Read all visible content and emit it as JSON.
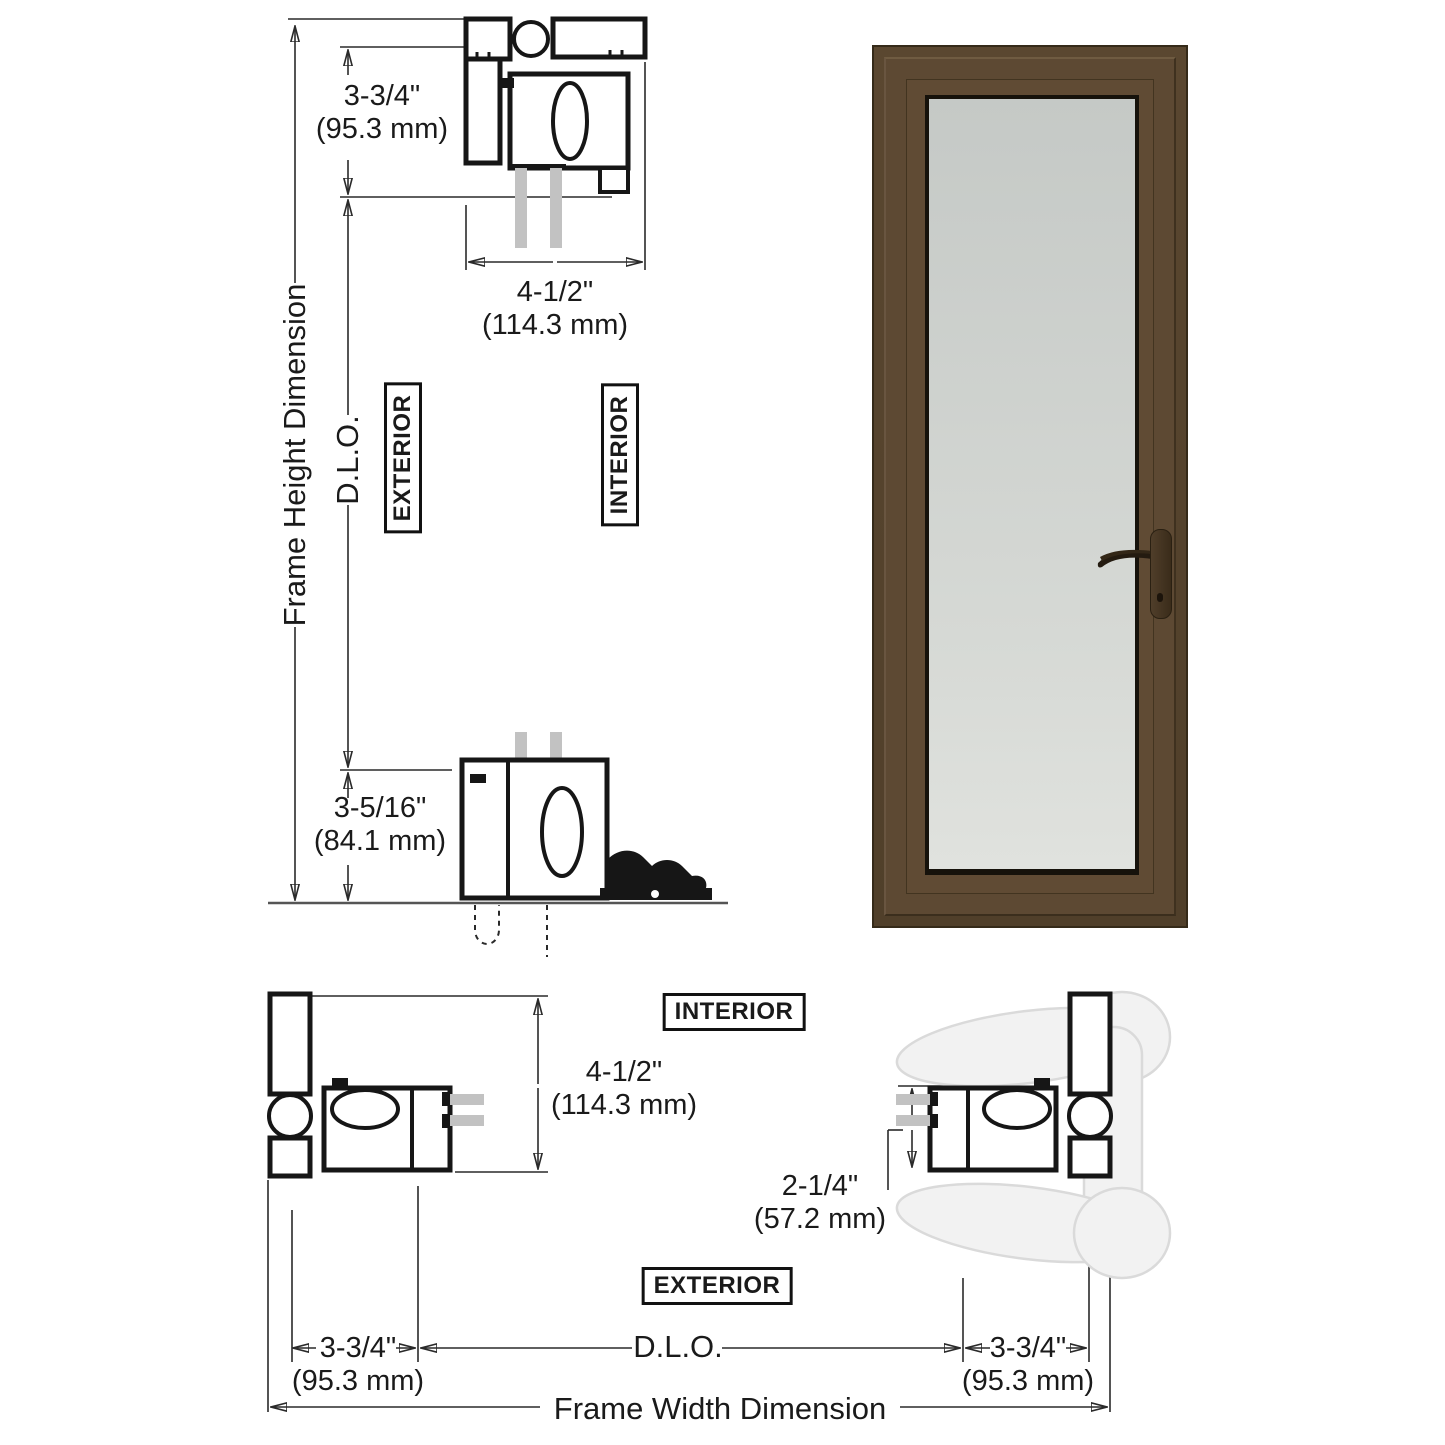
{
  "dims": {
    "head_drop": {
      "inches": "3-3/4\"",
      "metric": "(95.3 mm)"
    },
    "head_depth": {
      "inches": "4-1/2\"",
      "metric": "(114.3 mm)"
    },
    "sill_height": {
      "inches": "3-5/16\"",
      "metric": "(84.1 mm)"
    },
    "jamb_depth": {
      "inches": "4-1/2\"",
      "metric": "(114.3 mm)"
    },
    "stile_width": {
      "inches": "2-1/4\"",
      "metric": "(57.2 mm)"
    },
    "jamb_left": {
      "inches": "3-3/4\"",
      "metric": "(95.3 mm)"
    },
    "jamb_right": {
      "inches": "3-3/4\"",
      "metric": "(95.3 mm)"
    }
  },
  "axis_labels": {
    "frame_height": "Frame Height Dimension",
    "frame_width": "Frame Width Dimension",
    "dlo_vertical": "D.L.O.",
    "dlo_horizontal": "D.L.O."
  },
  "zone_labels": {
    "exterior_top": "EXTERIOR",
    "interior_top": "INTERIOR",
    "interior_bottom": "INTERIOR",
    "exterior_bottom": "EXTERIOR"
  },
  "colors": {
    "frame_bronze": "#57432e",
    "frame_bronze_dark": "#3c2f1f",
    "door_leaf": "#5e4a34",
    "glass_elevation": "#d2d5d1",
    "section_line": "#1c1c1c",
    "section_glass": "#c2c2c2"
  }
}
